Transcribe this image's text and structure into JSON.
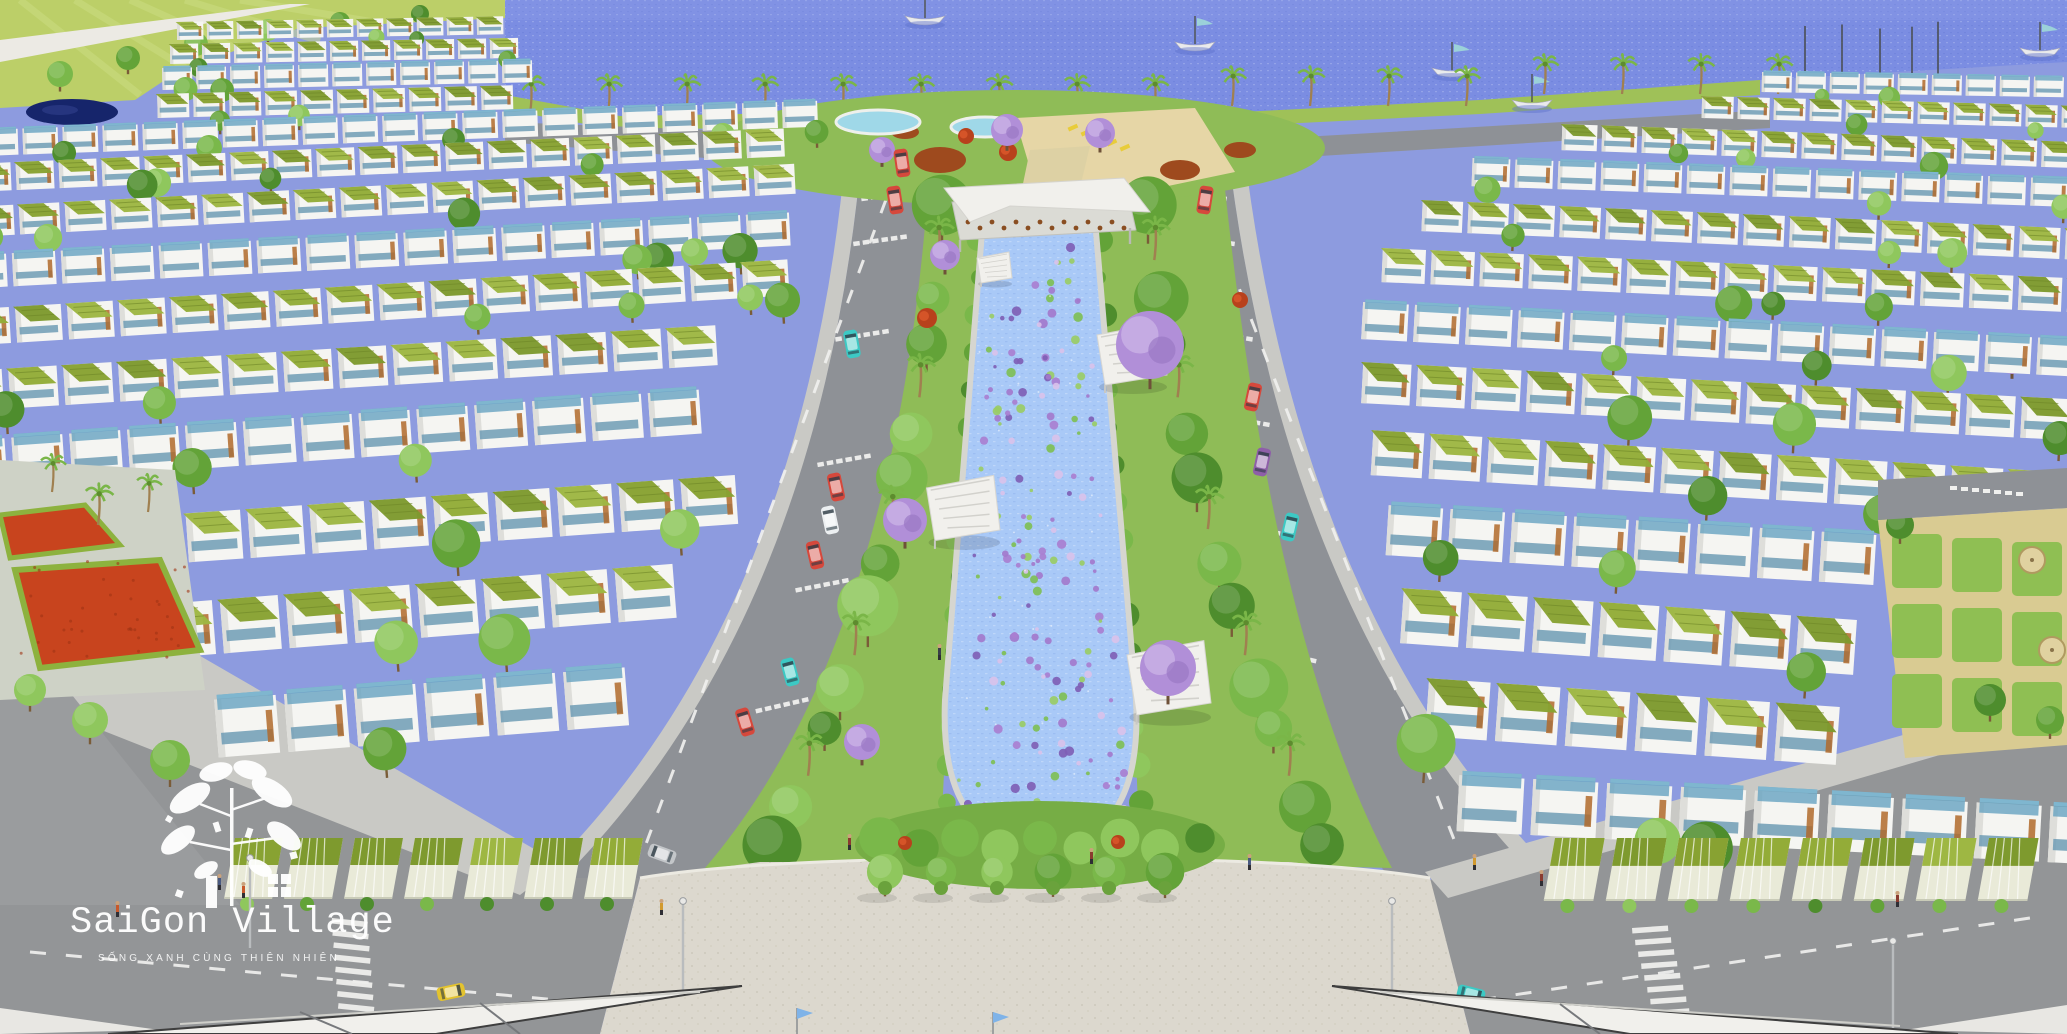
{
  "meta": {
    "title": "SaiGon Village — aerial masterplan 3D rendering",
    "description": "Bird's-eye architectural render of a riverside township: rows of white green-roofed townhouses, central lotus canal park, waterfront with sailboats, plaza with sail canopies"
  },
  "logo": {
    "title": "SaiGon Village",
    "tagline": "SỐNG XANH CÙNG THIÊN NHIÊN"
  },
  "palette": {
    "bay_water": "#7b8de2",
    "bay_water_light": "#93a2ec",
    "canal_water": "#a9c9f7",
    "canal_water_deep": "#8ab2f0",
    "grass_field": "#bccf68",
    "grass_shore": "#9fc158",
    "park_green": "#8fbc57",
    "tree_greens": [
      "#4e8d2d",
      "#63a338",
      "#7ab84a",
      "#8fc75d"
    ],
    "palm_green": "#7ab648",
    "roof_olive": [
      "#93ac38",
      "#88a232",
      "#9eb743",
      "#7e9a2e"
    ],
    "pergola_blue": "#66a3c0",
    "house_white": "#f5f5f2",
    "wood_accent": "#b06a2c",
    "road_gray": "#8e9196",
    "sidewalk": "#c9c9c5",
    "plaza": "#dcd8ce",
    "sand": "#e6d6a6",
    "flower_red": "#c8441e",
    "purple_bloom": "#b18fd8",
    "sail_white": "#f1f0ec",
    "pond_navy": "#16256b",
    "lotus_purple": "#a97fd0",
    "lotus_green": "#7fbf55"
  },
  "scene": {
    "boats": [
      {
        "x": 925,
        "y": 16
      },
      {
        "x": 1195,
        "y": 42
      },
      {
        "x": 1452,
        "y": 68
      },
      {
        "x": 1532,
        "y": 100
      },
      {
        "x": 2040,
        "y": 48
      }
    ],
    "marina_masts": [
      1805,
      1842,
      1880,
      1912,
      1938
    ],
    "cars": [
      {
        "color": "red",
        "x": 902,
        "y": 163,
        "rot": -8
      },
      {
        "color": "red",
        "x": 895,
        "y": 200,
        "rot": -9
      },
      {
        "color": "teal",
        "x": 852,
        "y": 344,
        "rot": -10
      },
      {
        "color": "red",
        "x": 836,
        "y": 487,
        "rot": -12
      },
      {
        "color": "white",
        "x": 830,
        "y": 520,
        "rot": -12
      },
      {
        "color": "red",
        "x": 815,
        "y": 555,
        "rot": -13
      },
      {
        "color": "teal",
        "x": 790,
        "y": 672,
        "rot": -15
      },
      {
        "color": "red",
        "x": 745,
        "y": 722,
        "rot": -17
      },
      {
        "color": "red",
        "x": 1205,
        "y": 200,
        "rot": 9
      },
      {
        "color": "red",
        "x": 1253,
        "y": 397,
        "rot": 12
      },
      {
        "color": "violet",
        "x": 1262,
        "y": 462,
        "rot": 12
      },
      {
        "color": "teal",
        "x": 1290,
        "y": 527,
        "rot": 13
      },
      {
        "color": "yellow",
        "x": 451,
        "y": 992,
        "rot": 78
      },
      {
        "color": "silver",
        "x": 662,
        "y": 854,
        "rot": -70
      },
      {
        "color": "teal",
        "x": 1471,
        "y": 994,
        "rot": 104
      }
    ],
    "car_colors": {
      "red": "#d6483c",
      "teal": "#3cc9c4",
      "yellow": "#e3c32f",
      "white": "#eceff1",
      "violet": "#8e5fa8",
      "silver": "#c3c6c9"
    },
    "pavilions": [
      {
        "x": 992,
        "y": 258,
        "s": 0.5
      },
      {
        "x": 1127,
        "y": 335,
        "s": 1.0
      },
      {
        "x": 958,
        "y": 488,
        "s": 1.05
      },
      {
        "x": 1163,
        "y": 655,
        "s": 1.2
      }
    ],
    "purple_trees": [
      {
        "x": 1007,
        "y": 130,
        "r": 16
      },
      {
        "x": 1100,
        "y": 133,
        "r": 15
      },
      {
        "x": 882,
        "y": 150,
        "r": 13
      },
      {
        "x": 945,
        "y": 255,
        "r": 15
      },
      {
        "x": 1150,
        "y": 345,
        "r": 34
      },
      {
        "x": 905,
        "y": 520,
        "r": 22
      },
      {
        "x": 1168,
        "y": 668,
        "r": 28
      },
      {
        "x": 862,
        "y": 742,
        "r": 18
      },
      {
        "x": 2012,
        "y": 358,
        "r": 16
      }
    ],
    "pools": [
      {
        "x": 878,
        "y": 122,
        "rx": 42,
        "ry": 12
      },
      {
        "x": 985,
        "y": 127,
        "rx": 34,
        "ry": 10
      }
    ],
    "lamps": [
      {
        "x": 683,
        "y": 903
      },
      {
        "x": 1392,
        "y": 903
      },
      {
        "x": 1893,
        "y": 943
      },
      {
        "x": 250,
        "y": 860
      }
    ],
    "flags": [
      {
        "x": 797,
        "y": 1008
      },
      {
        "x": 993,
        "y": 1012
      }
    ],
    "people": [
      [
        218,
        878
      ],
      [
        242,
        886
      ],
      [
        660,
        903
      ],
      [
        938,
        648
      ],
      [
        1090,
        852
      ],
      [
        1473,
        858
      ],
      [
        1540,
        874
      ],
      [
        1896,
        895
      ],
      [
        116,
        905
      ],
      [
        848,
        838
      ],
      [
        1248,
        858
      ]
    ],
    "crosswalk_ladders": [
      {
        "x": 332,
        "y": 918,
        "rot": 6
      },
      {
        "x": 1632,
        "y": 928,
        "rot": -4
      }
    ]
  }
}
